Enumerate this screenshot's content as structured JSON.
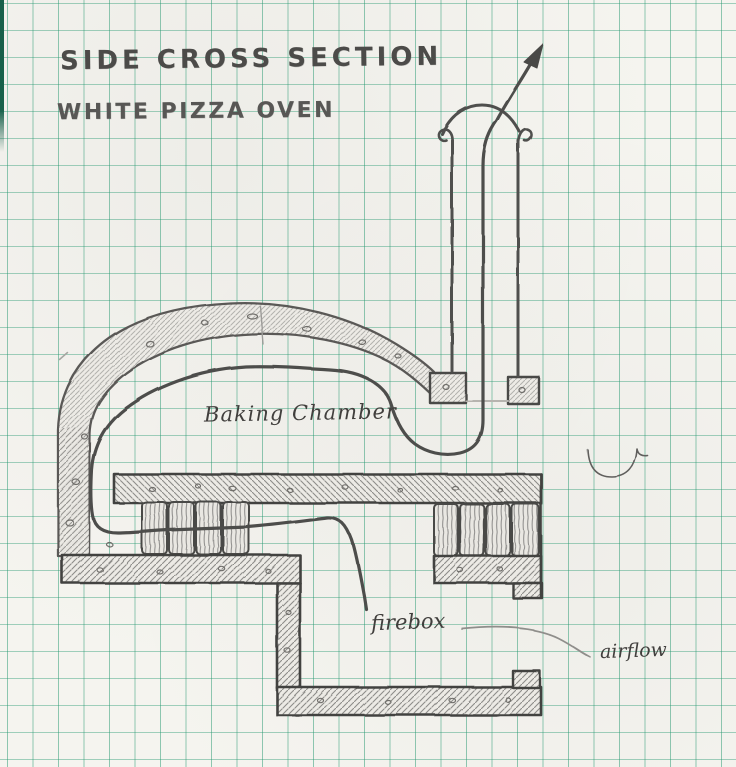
{
  "header": {
    "title_line1": "SIDE CROSS SECTION",
    "title_line2": "WHITE PIZZA OVEN"
  },
  "diagram": {
    "labels": {
      "baking_chamber": "Baking Chamber",
      "firebox": "firebox",
      "airflow": "airflow"
    },
    "icons": {
      "chimney_arrow": "exhaust-exit-arrow"
    }
  },
  "colors": {
    "paper": "#f5f4ef",
    "grid_line_green": "#4fa584",
    "pencil_dark": "#454441",
    "pencil_mid": "#6e6d6a",
    "pencil_light": "#a5a4a0"
  }
}
